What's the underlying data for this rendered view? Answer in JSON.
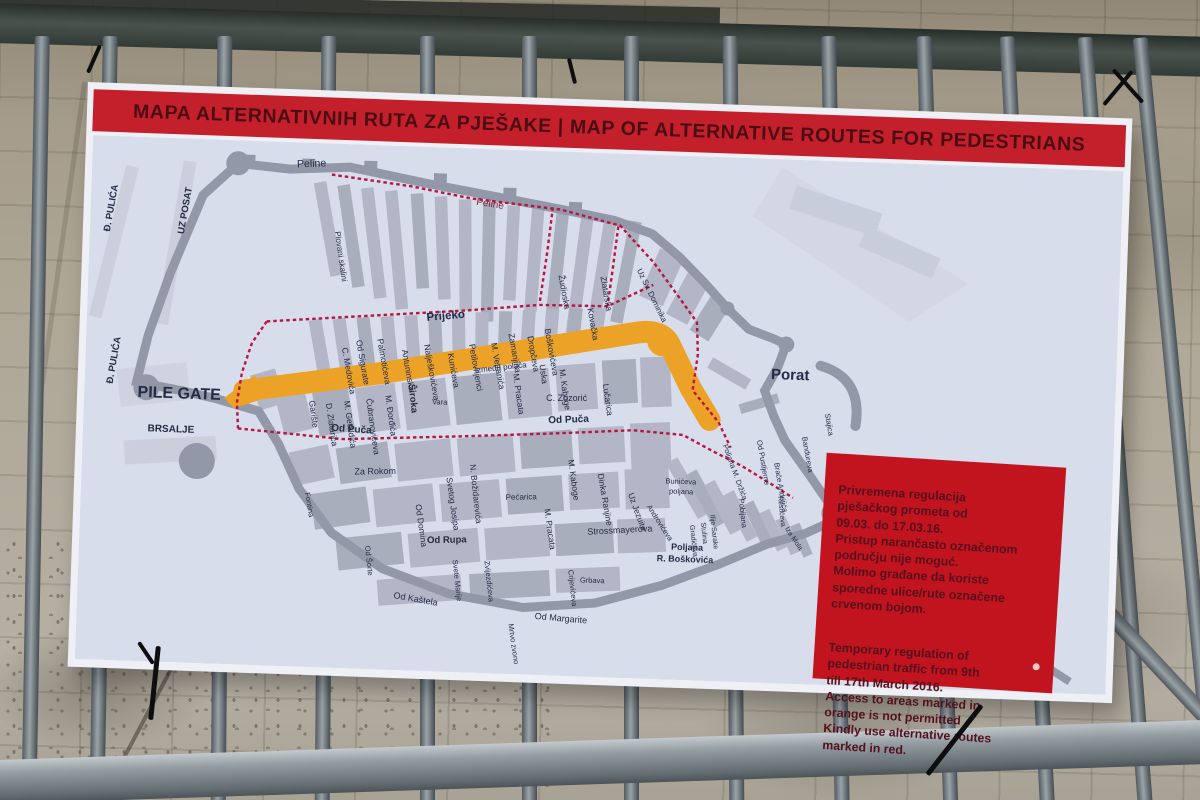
{
  "board": {
    "header": {
      "title": "MAPA ALTERNATIVNIH RUTA ZA PJEŠAKE | MAP OF ALTERNATIVE ROUTES FOR PEDESTRIANS"
    },
    "notice": {
      "croatian": "Privremena regulacija\npješačkog prometa od\n09.03. do 17.03.16.\nPristup narančasto označenom\npodručju nije moguć.\nMolimo građane da koriste\nsporedne ulice/rute označene\ncrvenom bojom.",
      "english": "Temporary regulation of\npedestrian traffic from 9th\ntill 17th March 2016.\nAccess to areas marked in\norange is not permitted\nKindly use alternative routes\nmarked in red."
    },
    "colors": {
      "header_red": "#c3202c",
      "header_text": "#4b0d14",
      "notice_red": "#c2141f",
      "notice_text": "#54101c",
      "route_orange": "#eca227",
      "route_red": "#b81540",
      "map_paper": "#d8ddec",
      "block_gray": "#b2b6c6",
      "wall_gray": "#9298a8",
      "label_navy": "#242b46"
    }
  },
  "map": {
    "labels": [
      {
        "t": "Peline",
        "x": 205,
        "y": 25,
        "r": -4,
        "s": 10.5
      },
      {
        "t": "Peline",
        "x": 385,
        "y": 56,
        "r": 7,
        "s": 10,
        "c": "#7c1a33"
      },
      {
        "t": "Plovani skalini",
        "x": 245,
        "y": 88,
        "r": 80,
        "s": 8
      },
      {
        "t": "Prijeko",
        "x": 340,
        "y": 174,
        "r": -7,
        "s": 11.5,
        "w": 700
      },
      {
        "t": "Od Sigurate",
        "x": 270,
        "y": 196,
        "r": 78
      },
      {
        "t": "Palmotićeva",
        "x": 291,
        "y": 194,
        "r": 78
      },
      {
        "t": "Antuninska",
        "x": 316,
        "y": 204,
        "r": 78
      },
      {
        "t": "Nalješkovićeva",
        "x": 338,
        "y": 198,
        "r": 78
      },
      {
        "t": "Kunićeva",
        "x": 362,
        "y": 206,
        "r": 78
      },
      {
        "t": "Petilovrijenci",
        "x": 383,
        "y": 196,
        "r": 78
      },
      {
        "t": "M. Vetranića",
        "x": 405,
        "y": 194,
        "r": 78
      },
      {
        "t": "Zamanjina",
        "x": 422,
        "y": 184,
        "r": 78
      },
      {
        "t": "Dropčeva",
        "x": 441,
        "y": 186,
        "r": 78
      },
      {
        "t": "Boškovićeva",
        "x": 458,
        "y": 178,
        "r": 78
      },
      {
        "t": "Žudioska",
        "x": 470,
        "y": 124,
        "r": 78
      },
      {
        "t": "Zlatarska",
        "x": 512,
        "y": 124,
        "r": 78
      },
      {
        "t": "Kovačka",
        "x": 500,
        "y": 156,
        "r": 78
      },
      {
        "t": "Uz Sv. Dominika",
        "x": 548,
        "y": 116,
        "r": 62,
        "s": 8
      },
      {
        "t": "C. Medovića",
        "x": 256,
        "y": 204,
        "r": 78
      },
      {
        "t": "Između polača",
        "x": 390,
        "y": 224,
        "r": -8,
        "s": 8
      },
      {
        "t": "M. Pracata",
        "x": 428,
        "y": 224,
        "r": 80
      },
      {
        "t": "Uska",
        "x": 454,
        "y": 214,
        "r": 80
      },
      {
        "t": "M. Kaboge",
        "x": 474,
        "y": 218,
        "r": 80
      },
      {
        "t": "Lučarica",
        "x": 518,
        "y": 231,
        "r": 80
      },
      {
        "t": "C. Zuzorić",
        "x": 462,
        "y": 250,
        "r": -2,
        "s": 9
      },
      {
        "t": "Široka",
        "x": 324,
        "y": 238,
        "r": 82,
        "s": 9.5,
        "w": 700
      },
      {
        "t": "Vara",
        "x": 348,
        "y": 257,
        "s": 7.5
      },
      {
        "t": "Garište",
        "x": 225,
        "y": 258,
        "r": 80
      },
      {
        "t": "D. Zlatarića",
        "x": 242,
        "y": 260,
        "r": 80
      },
      {
        "t": "M. Getaldića",
        "x": 260,
        "y": 257,
        "r": 80
      },
      {
        "t": "Čubranovićeva",
        "x": 282,
        "y": 254,
        "r": 80
      },
      {
        "t": "M. Đorđića",
        "x": 301,
        "y": 250,
        "r": 80
      },
      {
        "t": "N. Božidarevića",
        "x": 388,
        "y": 316,
        "r": 82
      },
      {
        "t": "Od Puča",
        "x": 248,
        "y": 287,
        "r": 2,
        "s": 10,
        "w": 700
      },
      {
        "t": "Od Puča",
        "x": 465,
        "y": 272,
        "r": -4,
        "s": 10,
        "w": 700
      },
      {
        "t": "Za Rokom",
        "x": 273,
        "y": 330,
        "r": -3,
        "s": 9
      },
      {
        "t": "Fontina",
        "x": 224,
        "y": 350,
        "r": 78,
        "s": 7.5
      },
      {
        "t": "Od Domina",
        "x": 335,
        "y": 358,
        "r": 80
      },
      {
        "t": "Svetog Josipa",
        "x": 365,
        "y": 330,
        "r": 80
      },
      {
        "t": "Pećarica",
        "x": 425,
        "y": 350,
        "r": -3,
        "s": 8
      },
      {
        "t": "M. Pracata",
        "x": 464,
        "y": 358,
        "r": 80
      },
      {
        "t": "M. Kaboge",
        "x": 486,
        "y": 308,
        "r": 80
      },
      {
        "t": "Dinka Ranjine",
        "x": 516,
        "y": 321,
        "r": 78
      },
      {
        "t": "Uz Jezuite",
        "x": 547,
        "y": 340,
        "r": 68
      },
      {
        "t": "Strossmayerova",
        "x": 508,
        "y": 382,
        "r": -5,
        "s": 9
      },
      {
        "t": "Od Rupa",
        "x": 348,
        "y": 396,
        "r": -3,
        "s": 9.5,
        "w": 700
      },
      {
        "t": "Od Šorte",
        "x": 286,
        "y": 401,
        "r": 82,
        "s": 7.5
      },
      {
        "t": "Svete Marije",
        "x": 374,
        "y": 412,
        "r": 82,
        "s": 7.5
      },
      {
        "t": "Zvijezdićeva",
        "x": 406,
        "y": 412,
        "r": 82,
        "s": 7.5
      },
      {
        "t": "Od Kaštela",
        "x": 316,
        "y": 452,
        "r": 8,
        "s": 9
      },
      {
        "t": "Od Margarite",
        "x": 458,
        "y": 468,
        "r": 3,
        "s": 9
      },
      {
        "t": "Mrtvo zvono",
        "x": 432,
        "y": 474,
        "r": 80,
        "s": 7.5
      },
      {
        "t": "Crijevićeva",
        "x": 490,
        "y": 418,
        "r": 82,
        "s": 7.5
      },
      {
        "t": "Grbava",
        "x": 502,
        "y": 430,
        "s": 7.5
      },
      {
        "t": "Poljana",
        "x": 592,
        "y": 394,
        "s": 9,
        "w": 700
      },
      {
        "t": "R. Boškovića",
        "x": 578,
        "y": 406,
        "s": 9,
        "w": 700
      },
      {
        "t": "Bunićeva",
        "x": 584,
        "y": 328,
        "s": 7.5
      },
      {
        "t": "poljana",
        "x": 588,
        "y": 338,
        "s": 7.5
      },
      {
        "t": "Androvićeva",
        "x": 566,
        "y": 352,
        "r": 55,
        "s": 7.5
      },
      {
        "t": "Poljana M. Držića",
        "x": 640,
        "y": 288,
        "r": 68,
        "s": 7.5
      },
      {
        "t": "Pobijana",
        "x": 658,
        "y": 341,
        "r": 82,
        "s": 7.5
      },
      {
        "t": "Ilije Sarake",
        "x": 630,
        "y": 358,
        "r": 82,
        "s": 7
      },
      {
        "t": "Stulina",
        "x": 621,
        "y": 366,
        "r": 82,
        "s": 7
      },
      {
        "t": "Gradićeva",
        "x": 610,
        "y": 369,
        "r": 82,
        "s": 7
      },
      {
        "t": "Od Pustijerne",
        "x": 674,
        "y": 282,
        "r": 78,
        "s": 7.5
      },
      {
        "t": "Braće Andrijića",
        "x": 692,
        "y": 304,
        "r": 78,
        "s": 7.5
      },
      {
        "t": "Bandureva",
        "x": 719,
        "y": 277,
        "r": 78,
        "s": 7.5
      },
      {
        "t": "Stajica",
        "x": 741,
        "y": 253,
        "r": 78,
        "s": 7.5
      },
      {
        "t": "Restićeva",
        "x": 697,
        "y": 337,
        "r": 82,
        "s": 7
      },
      {
        "t": "Iza Mola",
        "x": 705,
        "y": 369,
        "r": 55,
        "s": 7
      },
      {
        "t": "Porat",
        "x": 705,
        "y": 220,
        "s": 15,
        "w": 700,
        "a": "m"
      },
      {
        "t": "PILE GATE",
        "x": 95,
        "y": 260,
        "s": 16,
        "w": 700,
        "a": "m"
      },
      {
        "t": "BRSALJE",
        "x": 88,
        "y": 294,
        "s": 10,
        "w": 700,
        "a": "m"
      },
      {
        "t": "Đ. PULIĆA",
        "x": 20,
        "y": 96,
        "r": -82,
        "s": 9.5,
        "w": 700
      },
      {
        "t": "UZ POSAT",
        "x": 94,
        "y": 96,
        "r": -82,
        "s": 9.5,
        "w": 700
      },
      {
        "t": "Đ. PULIĆA",
        "x": 28,
        "y": 248,
        "r": -82,
        "s": 9.5,
        "w": 700
      }
    ]
  }
}
